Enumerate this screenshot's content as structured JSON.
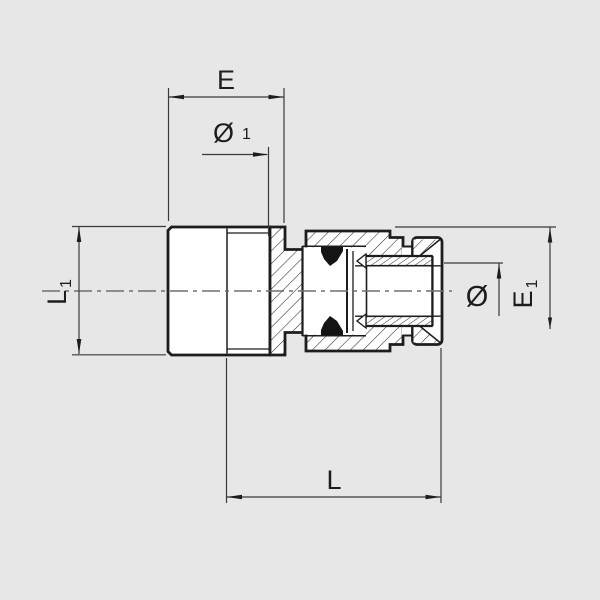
{
  "drawing": {
    "kind": "technical-section-drawing",
    "subject": "push-in pneumatic fitting, male stud with union nut, side section view",
    "background_color": "#e7e7e7",
    "outline_color": "#1d1d1d",
    "dimension_line_color": "#3a3a3a",
    "centerline_color": "#6f6f6f",
    "seal_color": "#141414",
    "dimensions": {
      "e": {
        "label": "E"
      },
      "d1": {
        "label": "Ø",
        "sub": "1"
      },
      "l1": {
        "label": "L",
        "sub": "1"
      },
      "d": {
        "label": "Ø"
      },
      "e1": {
        "label": "E",
        "sub": "1"
      },
      "l": {
        "label": "L"
      }
    }
  }
}
